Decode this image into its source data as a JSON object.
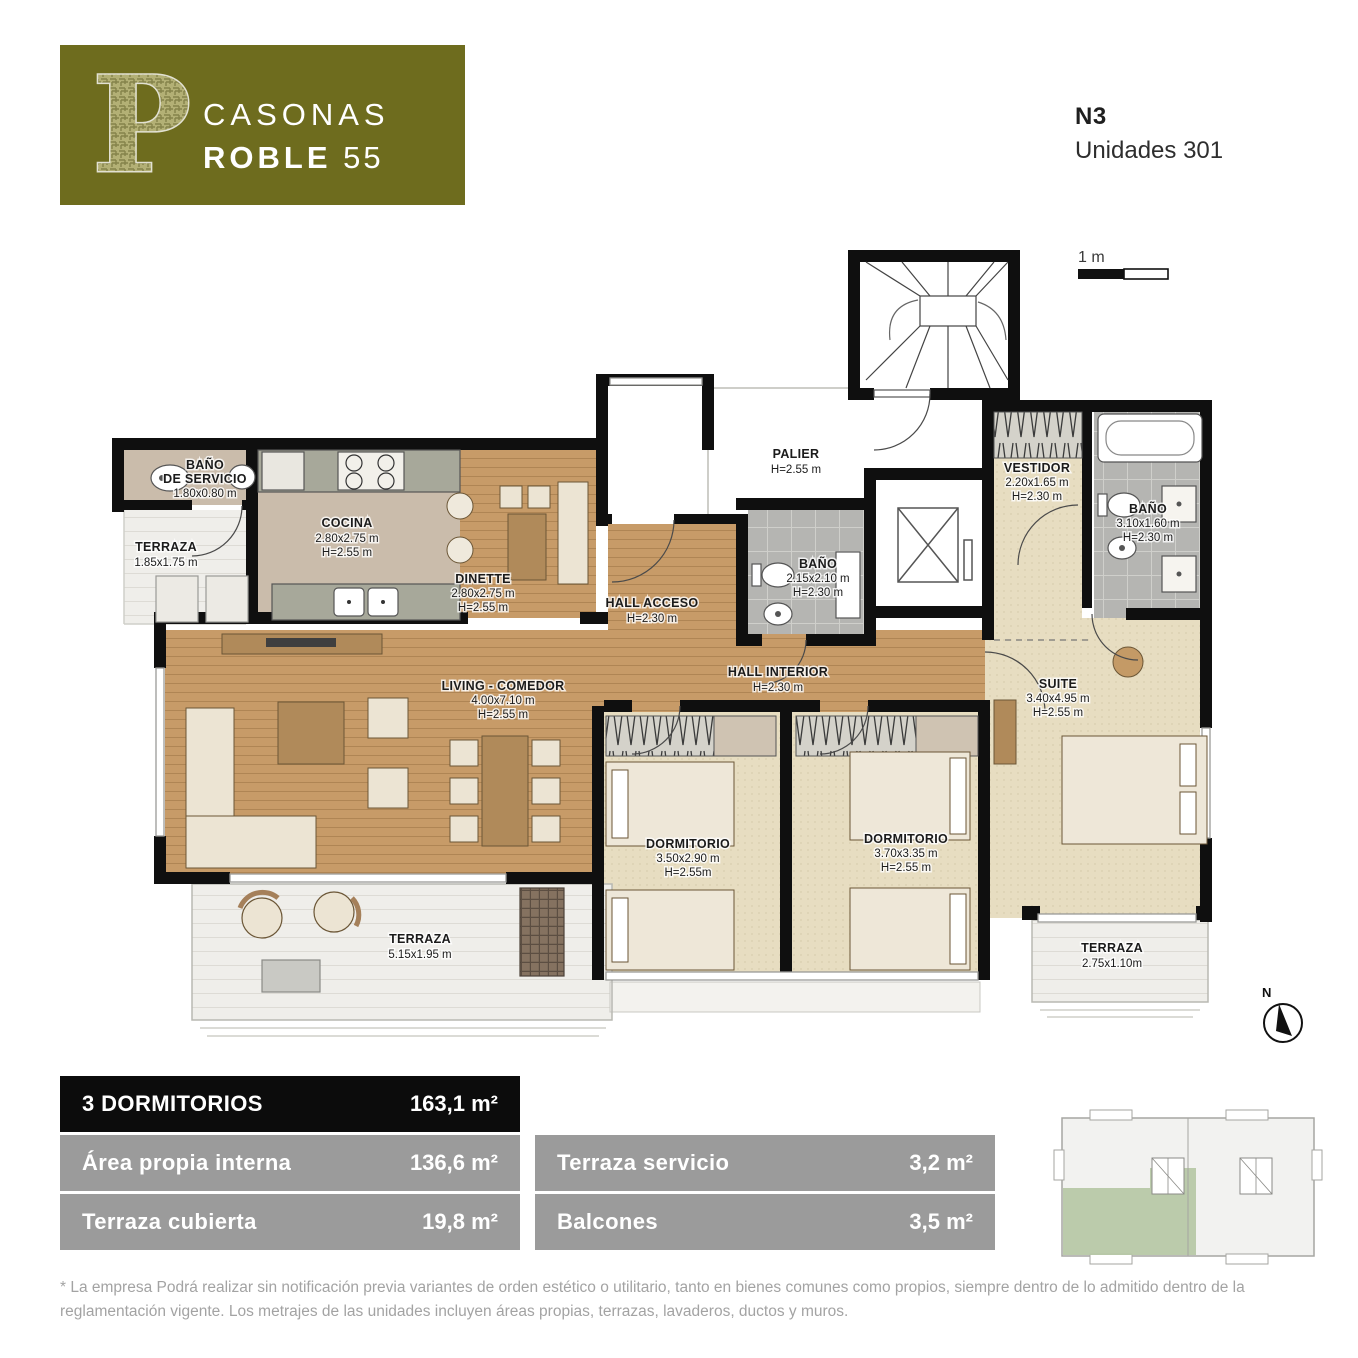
{
  "header": {
    "logo_letter": "P",
    "brand_line1": "CASONAS",
    "brand_line2_bold": "ROBLE",
    "brand_line2_regular": "55",
    "level": "N3",
    "units": "Unidades 301"
  },
  "scale": {
    "label": "1 m"
  },
  "compass": {
    "label": "N"
  },
  "floorplan": {
    "rooms": {
      "bano_servicio": {
        "l1": "BAÑO",
        "l2": "DE SERVICIO",
        "l3": "1.80x0.80 m"
      },
      "terraza_servicio": {
        "l1": "TERRAZA",
        "l2": "1.85x1.75 m"
      },
      "cocina": {
        "l1": "COCINA",
        "l2": "2.80x2.75 m",
        "l3": "H=2.55 m"
      },
      "dinette": {
        "l1": "DINETTE",
        "l2": "2.80x2.75 m",
        "l3": "H=2.55 m"
      },
      "palier": {
        "l1": "PALIER",
        "l2": "H=2.55 m"
      },
      "hall_acceso": {
        "l1": "HALL ACCESO",
        "l2": "H=2.30 m"
      },
      "bano_central": {
        "l1": "BAÑO",
        "l2": "2.15x2.10 m",
        "l3": "H=2.30 m"
      },
      "vestidor": {
        "l1": "VESTIDOR",
        "l2": "2.20x1.65 m",
        "l3": "H=2.30 m"
      },
      "bano_suite": {
        "l1": "BAÑO",
        "l2": "3.10x1.60 m",
        "l3": "H=2.30 m"
      },
      "living_comedor": {
        "l1": "LIVING - COMEDOR",
        "l2": "4.00x7.10 m",
        "l3": "H=2.55 m"
      },
      "hall_interior": {
        "l1": "HALL INTERIOR",
        "l2": "H=2.30 m"
      },
      "dormitorio_1": {
        "l1": "DORMITORIO",
        "l2": "3.50x2.90 m",
        "l3": "H=2.55m"
      },
      "dormitorio_2": {
        "l1": "DORMITORIO",
        "l2": "3.70x3.35 m",
        "l3": "H=2.55 m"
      },
      "suite": {
        "l1": "SUITE",
        "l2": "3.40x4.95 m",
        "l3": "H=2.55 m"
      },
      "terraza_principal": {
        "l1": "TERRAZA",
        "l2": "5.15x1.95 m"
      },
      "terraza_suite": {
        "l1": "TERRAZA",
        "l2": "2.75x1.10m"
      }
    }
  },
  "summary": {
    "header": {
      "label": "3 DORMITORIOS",
      "value": "163,1 m²"
    },
    "rows_left": [
      {
        "label": "Área propia interna",
        "value": "136,6 m²"
      },
      {
        "label": "Terraza cubierta",
        "value": "19,8 m²"
      }
    ],
    "rows_right": [
      {
        "label": "Terraza servicio",
        "value": "3,2 m²"
      },
      {
        "label": "Balcones",
        "value": "3,5 m²"
      }
    ]
  },
  "disclaimer": "* La empresa Podrá realizar sin notificación previa variantes de orden estético o utilitario, tanto en bienes comunes como propios, siempre dentro de lo admitido dentro de la reglamentación vigente. Los metrajes de las unidades incluyen áreas propias, terrazas, lavaderos, ductos y muros.",
  "colors": {
    "brand_olive": "#6e6c1e",
    "table_black": "#0c0c0c",
    "table_gray": "#9b9b9b",
    "keyplan_green": "#b6c8a5",
    "wood": "#c79b68"
  }
}
